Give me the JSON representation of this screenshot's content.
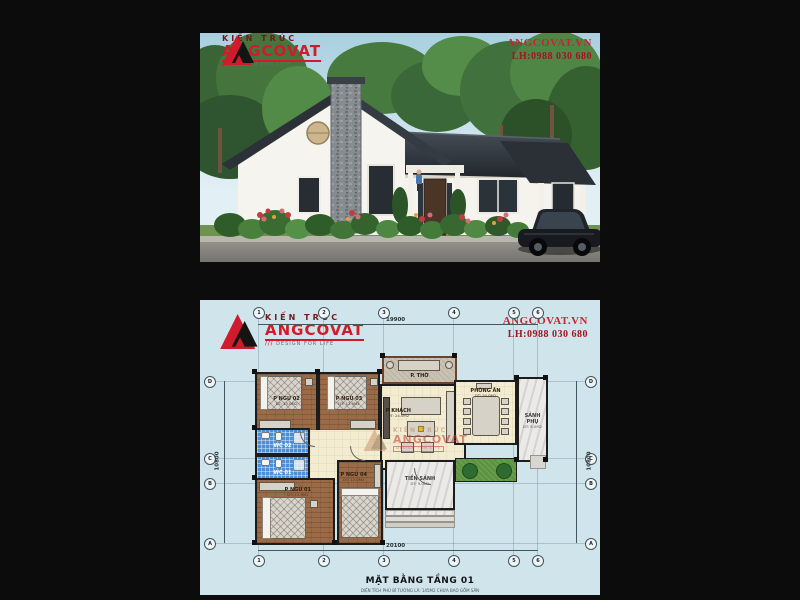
{
  "brand": {
    "kien_truc": "KIẾN TRÚC",
    "name": "ANGCOVAT",
    "tagline": "DESIGN FOR LIFE",
    "slashes": "///"
  },
  "contact": {
    "website": "ANGCOVAT.VN",
    "phone": "LH:0988 030 680"
  },
  "plan": {
    "title": "MẶT BẰNG TẦNG 01",
    "subtitle": "DIỆN TÍCH PHỦ BÌ TƯỜNG LÀ: 145M2 CHƯA BAO GỒM SÂN",
    "dimensions": {
      "top": "19900",
      "bottom": "20100",
      "left": "10800",
      "right": "10800"
    },
    "grid": {
      "top": [
        "1",
        "2",
        "3",
        "4",
        "5",
        "6"
      ],
      "bottom": [
        "1",
        "2",
        "3",
        "4",
        "5",
        "6"
      ],
      "left": [
        "D",
        "C",
        "B",
        "A"
      ],
      "right": [
        "D",
        "C",
        "B",
        "A"
      ]
    },
    "rooms": {
      "p_tho": {
        "label": "P. THỜ",
        "area": "DT: 6.0M2"
      },
      "p_ngu_02": {
        "label": "P NGỦ 02",
        "area": "DT: 13.0M2"
      },
      "p_ngu_03": {
        "label": "P NGỦ 03",
        "area": "DT: 12.5M2"
      },
      "p_khach": {
        "label": "P KHÁCH",
        "area": "DT: 24.0M2"
      },
      "phong_an": {
        "label": "PHÒNG ĂN",
        "area": "DT: 20.0M2"
      },
      "sanh_phu": {
        "label": "SẢNH PHỤ",
        "area": "DT: 8.0M2"
      },
      "wc_02": {
        "label": "WC 02"
      },
      "wc_01": {
        "label": "WC 01"
      },
      "p_ngu_01": {
        "label": "P NGỦ 01",
        "area": "DT: 13.5M2"
      },
      "p_ngu_04": {
        "label": "P NGỦ 04",
        "area": "DT: 12.0M2"
      },
      "tien_sanh": {
        "label": "TIỀN SẢNH",
        "area": "DT: 9.0M2"
      }
    }
  },
  "colors": {
    "accent_red": "#cf1b2b",
    "plan_bg": "#cfe4eb",
    "roof": "#2b3138",
    "sky": "#a9cfdf"
  }
}
